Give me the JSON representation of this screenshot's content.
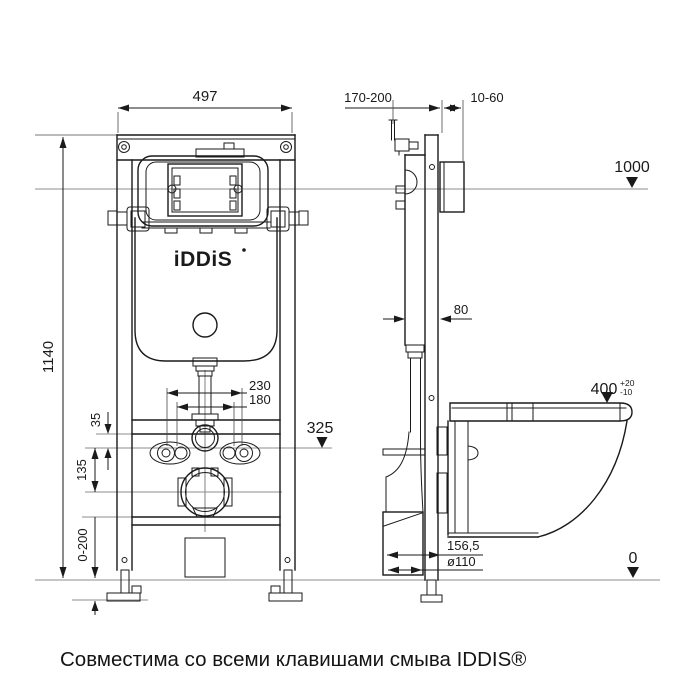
{
  "page": {
    "background": "#ffffff",
    "caption": "Совместима со всеми клавишами смыва IDDIS®"
  },
  "brand": {
    "logo_text": "iDDiS"
  },
  "colors": {
    "line": "#1a1a1a",
    "reference_line": "#8c8c8c",
    "background": "#ffffff"
  },
  "front_view": {
    "dim_width": "497",
    "dim_height": "1140",
    "dim_bolt_spacing_wide": "230",
    "dim_bolt_spacing_narrow": "180",
    "dim_bracket_offset": "35",
    "dim_drain_offset": "135",
    "dim_foot_adjust": "0-200",
    "dim_outlet_level": "325"
  },
  "side_view": {
    "dim_depth_adjust": "170-200",
    "dim_plate_depth": "10-60",
    "dim_top_level": "1000",
    "dim_profile_depth": "80",
    "dim_bowl_height": "400",
    "dim_bowl_height_tol_plus": "+20",
    "dim_bowl_height_tol_minus": "-10",
    "dim_drain_to_wall": "156,5",
    "dim_drain_pipe": "ø110",
    "dim_floor_level": "0"
  }
}
